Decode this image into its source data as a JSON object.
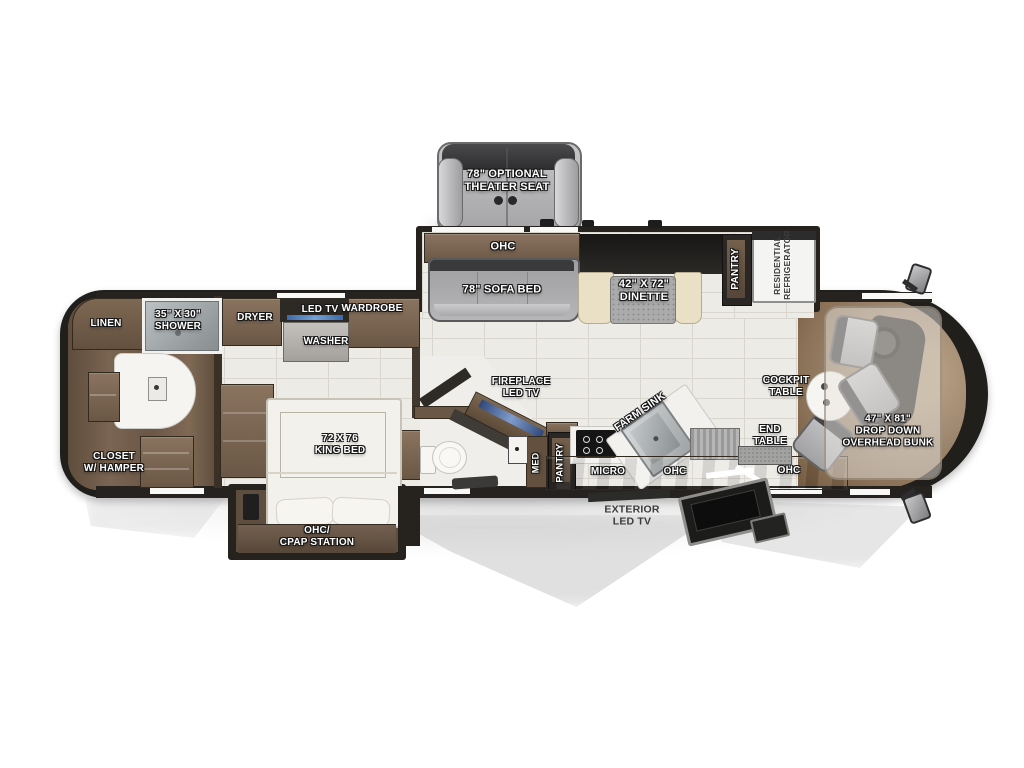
{
  "plan": {
    "type": "rv-floorplan",
    "palette": {
      "hull_dark": "#211f1c",
      "wall_dark": "#26221f",
      "wood_floor": "#6e5a49",
      "cabinet_brown": "#7a6550",
      "tile_floor": "#edebe6",
      "sofa_gray": "#a9a9ab",
      "bench_cream": "#e9e0c6",
      "tv_blue": "#4a7ab5",
      "label_white": "#ffffff",
      "label_dark": "#3c3c3c",
      "cockpit_wood": "#a08a72"
    }
  },
  "labels": {
    "theater_seat": "78\" OPTIONAL\nTHEATER SEAT",
    "ohc_sofa": "OHC",
    "sofa_bed": "78\" SOFA BED",
    "dinette": "42\" X 72\"\nDINETTE",
    "pantry_slide": "PANTRY",
    "refrigerator": "RESIDENTIAL\nREFRIGERATOR",
    "linen": "LINEN",
    "shower": "35\" X 30\"\nSHOWER",
    "dryer": "DRYER",
    "led_tv": "LED TV",
    "wardrobe": "WARDROBE",
    "washer": "WASHER",
    "closet_hamper": "CLOSET\nW/ HAMPER",
    "king_bed": "72 X 76\nKING BED",
    "fireplace": "FIREPLACE\nLED TV",
    "med": "MED",
    "pantry_kitchen": "PANTRY",
    "micro": "MICRO",
    "ohc_kitchen": "OHC",
    "farm_sink": "FARM SINK",
    "end_table": "END\nTABLE",
    "ohc_living": "OHC",
    "cockpit_table": "COCKPIT\nTABLE",
    "overhead_bunk": "47\" X 81\"\nDROP DOWN\nOVERHEAD BUNK",
    "ohc_cpap": "OHC/\nCPAP STATION",
    "exterior_tv": "EXTERIOR\nLED TV"
  }
}
